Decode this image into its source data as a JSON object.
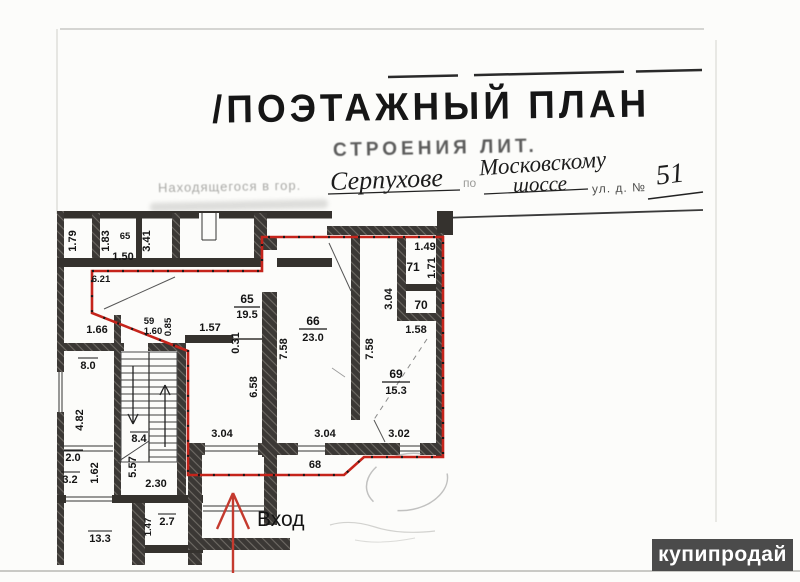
{
  "watermark": {
    "text": "купипродай"
  },
  "header": {
    "slash": "/",
    "title": "ПОЭТАЖНЫЙ ПЛАН",
    "subtitle": "СТРОЕНИЯ ЛИТ.",
    "located_line": "Находящегося в гор.",
    "preposition": "по",
    "city": "Серпухове",
    "street_line1": "Московскому",
    "street_line2": "шоссе",
    "house_label": "ул. д. №",
    "house_number": "51"
  },
  "plan": {
    "entrance_label": "Вход",
    "rooms": {
      "r65_small": "65",
      "r65": "65",
      "a65": "19.5",
      "r66": "66",
      "a66": "23.0",
      "r69": "69",
      "a69": "15.3",
      "r70": "70",
      "r71": "71",
      "r59": "59",
      "r68": "68"
    },
    "dims": {
      "d179": "1.79",
      "d183": "1.83",
      "d150": "1.50",
      "d341": "3.41",
      "d621": "6.21",
      "d166": "1.66",
      "d160": "1.60",
      "d085": "0.85",
      "d157": "1.57",
      "d031": "0.31",
      "d80": "8.0",
      "d482": "4.82",
      "d84": "8.4",
      "d20": "2.0",
      "d32": "3.2",
      "d162": "1.62",
      "d557": "5.57",
      "d230": "2.30",
      "d133": "13.3",
      "d147": "1.47",
      "d27": "2.7",
      "d304a": "3.04",
      "d304b": "3.04",
      "d302": "3.02",
      "d658": "6.58",
      "d758a": "7.58",
      "d758b": "7.58",
      "d158": "1.58",
      "d149": "1.49",
      "d171": "1.71",
      "d304v": "3.04"
    }
  }
}
